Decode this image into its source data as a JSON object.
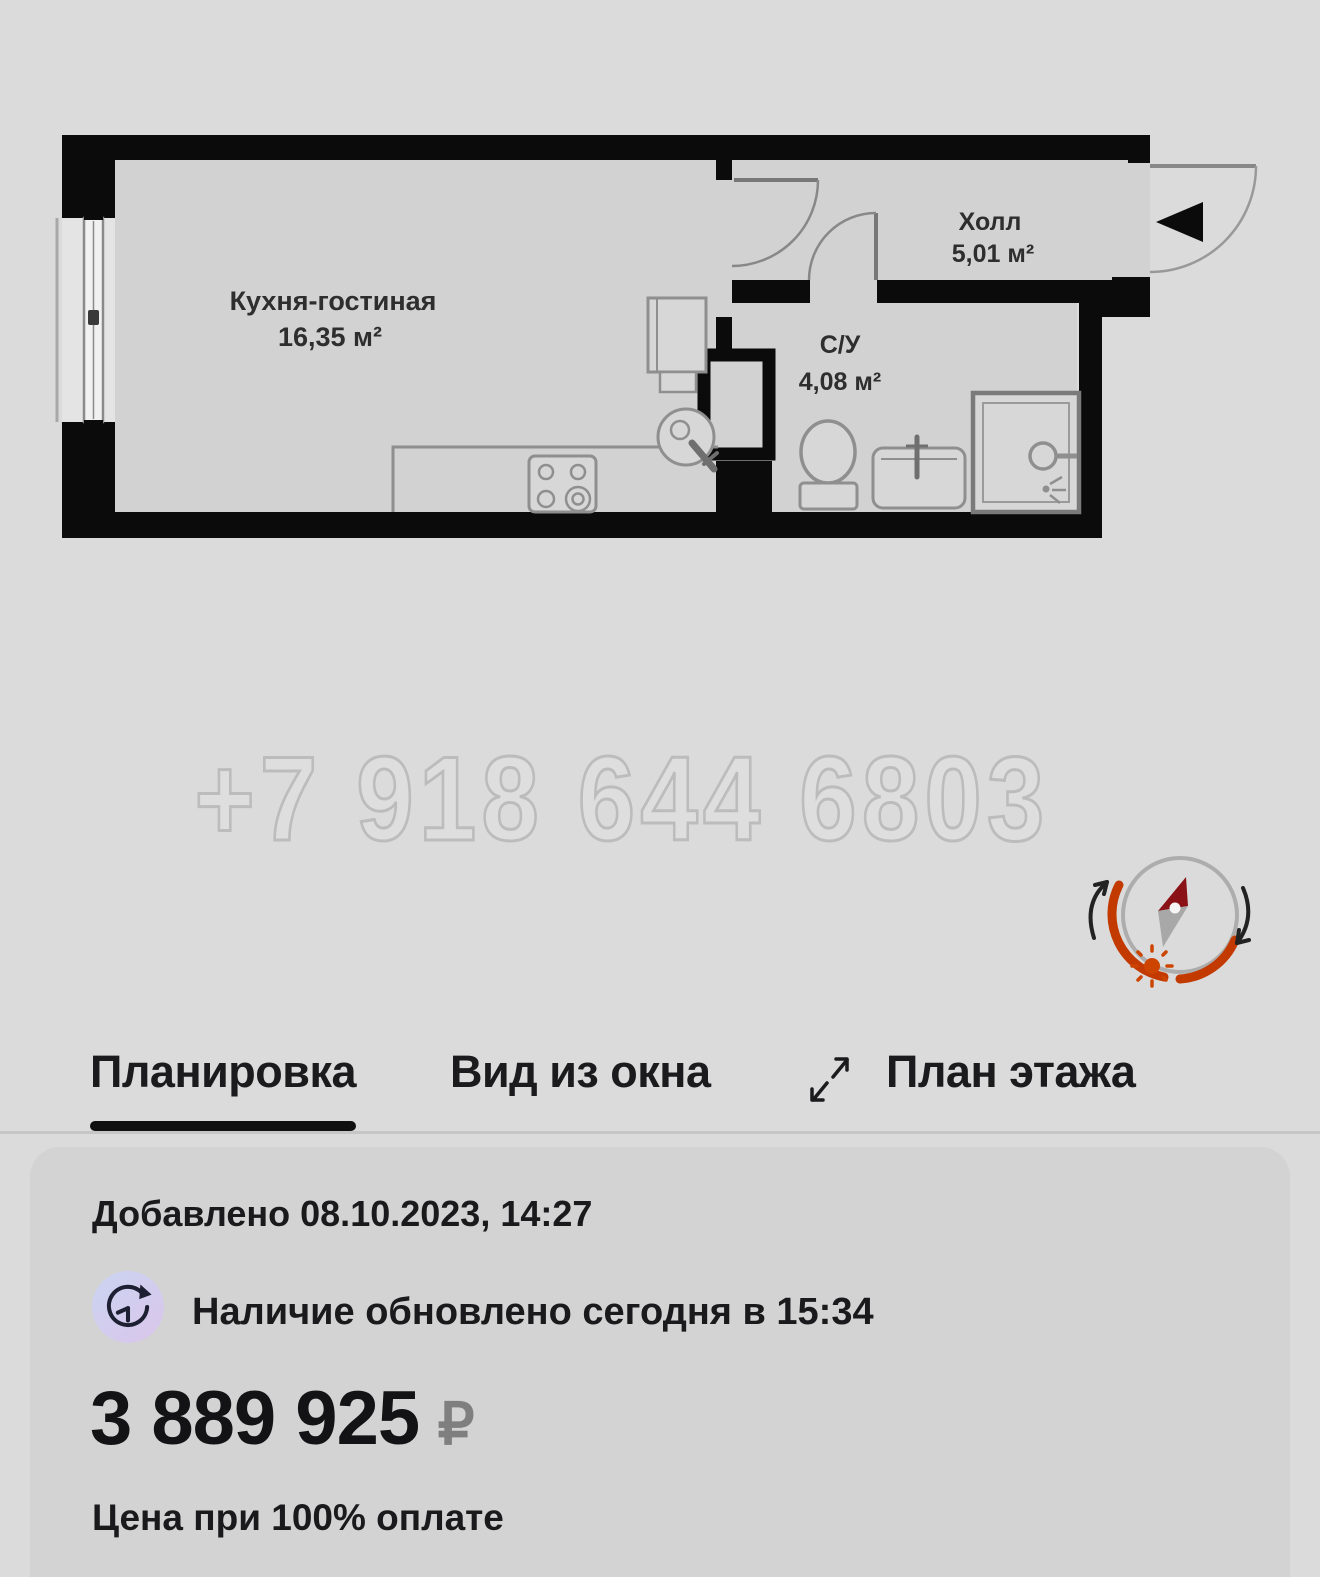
{
  "floor_plan": {
    "watermark_phone": "+7 918 644 6803",
    "rooms": [
      {
        "name": "Кухня-гостиная",
        "area": "16,35 м²"
      },
      {
        "name": "Холл",
        "area": "5,01 м²"
      },
      {
        "name": "С/У",
        "area": "4,08 м²"
      }
    ]
  },
  "tabs": {
    "layout": "Планировка",
    "window_view": "Вид из окна",
    "floor_plan": "План этажа"
  },
  "card": {
    "added": "Добавлено 08.10.2023, 14:27",
    "availability": "Наличие обновлено сегодня в 15:34",
    "price": "3 889 925",
    "currency": "₽",
    "price_note": "Цена при 100% оплате"
  },
  "colors": {
    "page_bg": "#dbdbdb",
    "card_bg": "#d3d3d3",
    "wall_black": "#0b0b0b",
    "compass_orange": "#c23a00",
    "needle_red": "#8a1217",
    "badge_lavender": "#ccd3f1",
    "active_tab": "#101010"
  }
}
